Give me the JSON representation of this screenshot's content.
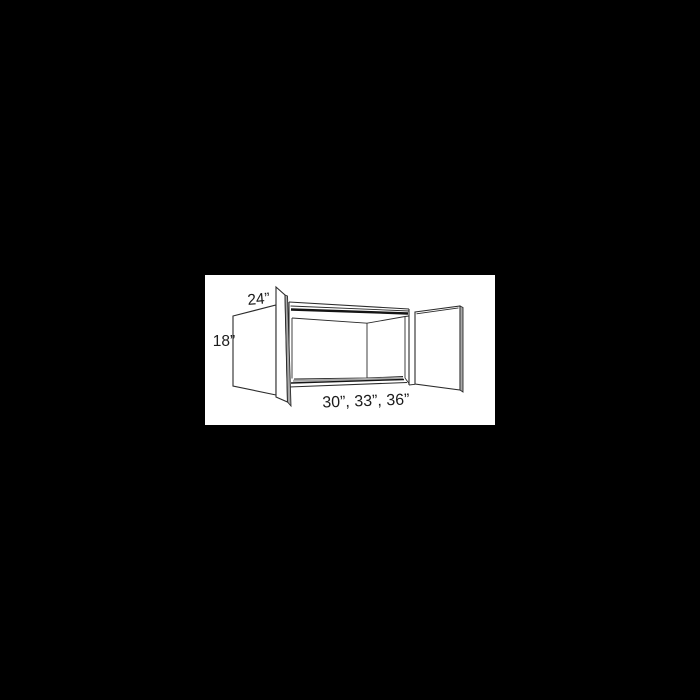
{
  "page": {
    "background_color": "#000000",
    "width": 700,
    "height": 700
  },
  "panel": {
    "background_color": "#ffffff"
  },
  "diagram": {
    "subject": "open two-door wall cabinet line drawing",
    "line_color": "#2b2b2b",
    "strong_line_color": "#141414",
    "shade_color": "#a8a8a8",
    "text_color": "#1c1c1c",
    "labels": {
      "depth": "24”",
      "height": "18”",
      "width_options": "30”, 33”, 36”"
    }
  }
}
